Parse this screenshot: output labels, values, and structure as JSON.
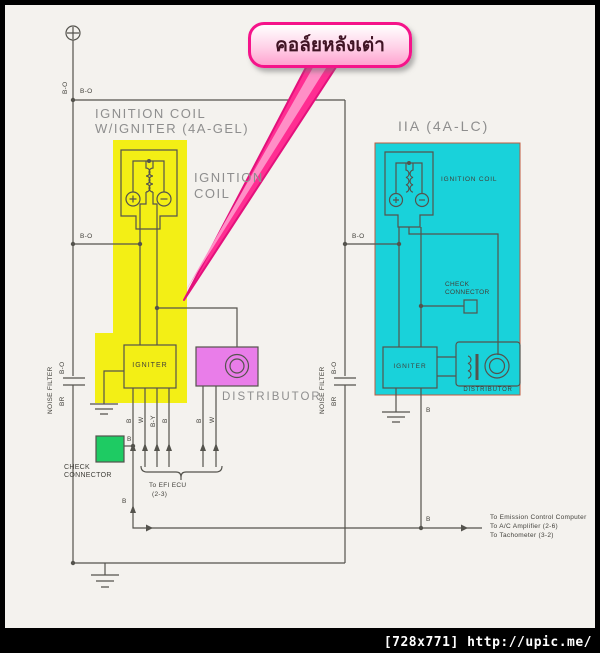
{
  "callout": {
    "text": "คอล์ยหลังเต่า"
  },
  "footer": {
    "text": "[728x771] http://upic.me/"
  },
  "left": {
    "title1": "IGNITION COIL",
    "title2": "W/IGNITER (4A-GEL)",
    "coil1": "IGNITION",
    "coil2": "COIL",
    "igniter": "IGNITER",
    "distributor": "DISTRIBUTOR",
    "check1": "CHECK",
    "check2": "CONNECTOR",
    "noise": "NOISE FILTER",
    "ecu1": "To EFI ECU",
    "ecu2": "(2-3)"
  },
  "right": {
    "title": "IIA (4A-LC)",
    "coil": "IGNITION COIL",
    "igniter": "IGNITER",
    "distributor": "DISTRIBUTOR",
    "check1": "CHECK",
    "check2": "CONNECTOR",
    "noise": "NOISE FILTER"
  },
  "dest": {
    "l1": "To Emission Control Computer",
    "l2": "To A/C Amplifier (2-6)",
    "l3": "To Tachometer (3-2)"
  },
  "wires": {
    "bo": "B-O",
    "b": "B",
    "w": "W",
    "by": "B-Y",
    "br": "BR"
  },
  "colors": {
    "highlight_yellow": "#f3ef15",
    "highlight_cyan": "#19d2da",
    "distributor_magenta": "#e97de9",
    "check_connector_green": "#1ecb63",
    "callout_pink": "#ff2e92",
    "line_gray": "#54534d",
    "label_gray": "#8e8e8e"
  }
}
